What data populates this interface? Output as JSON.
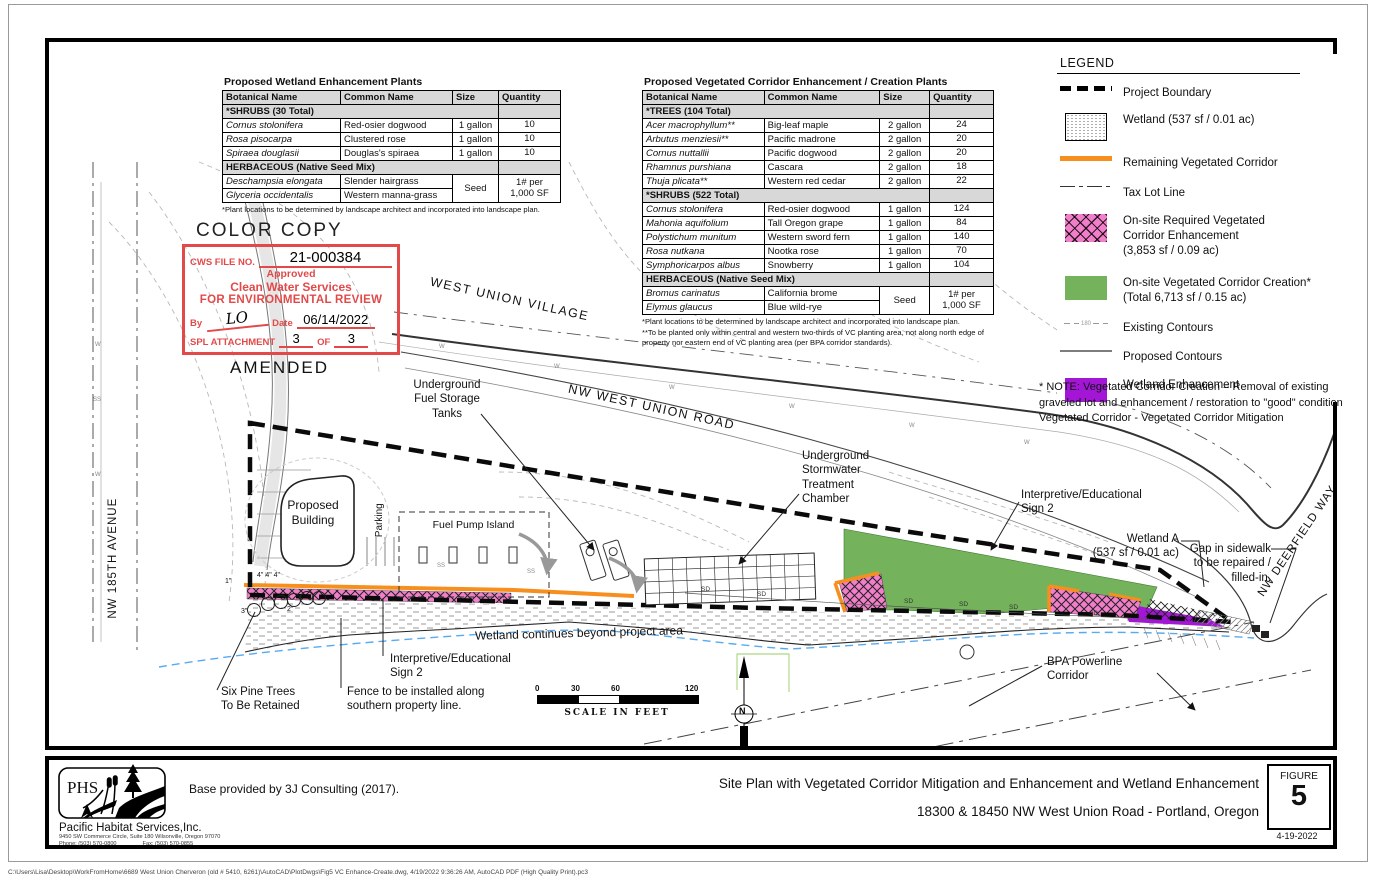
{
  "colors": {
    "green": "#74b35c",
    "pink": "#f07ec9",
    "purple": "#a316d6",
    "orange": "#f78f1e",
    "stamp_red": "#e24a4a",
    "water_blue": "#58aaf0"
  },
  "tables": [
    {
      "title": "Proposed Wetland Enhancement Plants",
      "headers": [
        "Botanical Name",
        "Common Name",
        "Size",
        "Quantity"
      ],
      "rows": [
        {
          "type": "section",
          "label": "*SHRUBS (30 Total)"
        },
        {
          "type": "plant",
          "botanical": "Cornus stolonifera",
          "common": "Red-osier dogwood",
          "size": "1 gallon",
          "qty": "10"
        },
        {
          "type": "plant",
          "botanical": "Rosa pisocarpa",
          "common": "Clustered rose",
          "size": "1 gallon",
          "qty": "10"
        },
        {
          "type": "plant",
          "botanical": "Spiraea douglasii",
          "common": "Douglas's spiraea",
          "size": "1 gallon",
          "qty": "10"
        },
        {
          "type": "section",
          "label": "HERBACEOUS (Native Seed Mix)"
        },
        {
          "type": "seedgroup",
          "plants": [
            [
              "Deschampsia elongata",
              "Slender hairgrass"
            ],
            [
              "Glyceria occidentalis",
              "Western manna-grass"
            ]
          ],
          "size": "Seed",
          "qty": "1# per\n1,000 SF"
        }
      ],
      "footnotes": [
        "*Plant locations to be determined by landscape architect and incorporated into landscape plan."
      ]
    },
    {
      "title": "Proposed Vegetated Corridor Enhancement / Creation Plants",
      "headers": [
        "Botanical Name",
        "Common Name",
        "Size",
        "Quantity"
      ],
      "rows": [
        {
          "type": "section",
          "label": "*TREES (104 Total)"
        },
        {
          "type": "plant",
          "botanical": "Acer macrophyllum**",
          "common": "Big-leaf maple",
          "size": "2 gallon",
          "qty": "24"
        },
        {
          "type": "plant",
          "botanical": "Arbutus menziesii**",
          "common": "Pacific madrone",
          "size": "2 gallon",
          "qty": "20"
        },
        {
          "type": "plant",
          "botanical": "Cornus nuttallii",
          "common": "Pacific dogwood",
          "size": "2 gallon",
          "qty": "20"
        },
        {
          "type": "plant",
          "botanical": "Rhamnus purshiana",
          "common": "Cascara",
          "size": "2 gallon",
          "qty": "18"
        },
        {
          "type": "plant",
          "botanical": "Thuja plicata**",
          "common": "Western red cedar",
          "size": "2 gallon",
          "qty": "22"
        },
        {
          "type": "section",
          "label": "*SHRUBS (522 Total)"
        },
        {
          "type": "plant",
          "botanical": "Cornus stolonifera",
          "common": "Red-osier dogwood",
          "size": "1 gallon",
          "qty": "124"
        },
        {
          "type": "plant",
          "botanical": "Mahonia aquifolium",
          "common": "Tall Oregon grape",
          "size": "1 gallon",
          "qty": "84"
        },
        {
          "type": "plant",
          "botanical": "Polystichum munitum",
          "common": "Western sword fern",
          "size": "1 gallon",
          "qty": "140"
        },
        {
          "type": "plant",
          "botanical": "Rosa nutkana",
          "common": "Nootka rose",
          "size": "1 gallon",
          "qty": "70"
        },
        {
          "type": "plant",
          "botanical": "Symphoricarpos albus",
          "common": "Snowberry",
          "size": "1 gallon",
          "qty": "104"
        },
        {
          "type": "section",
          "label": "HERBACEOUS (Native Seed Mix)"
        },
        {
          "type": "seedgroup",
          "plants": [
            [
              "Bromus carinatus",
              "California brome"
            ],
            [
              "Elymus glaucus",
              "Blue wild-rye"
            ]
          ],
          "size": "Seed",
          "qty": "1# per\n1,000 SF"
        }
      ],
      "footnotes": [
        "*Plant locations to be determined by landscape architect and incorporated into landscape plan.",
        "**To be planted only within central and western two-thirds of VC planting area, not along north edge of property nor eastern end of VC planting area (per BPA corridor standards)."
      ]
    }
  ],
  "legend": {
    "title": "LEGEND",
    "items": [
      {
        "swatch": "project-boundary",
        "text": "Project Boundary"
      },
      {
        "swatch": "wetland",
        "text": "Wetland (537 sf / 0.01 ac)"
      },
      {
        "swatch": "remaining-vc",
        "text": "Remaining Vegetated Corridor"
      },
      {
        "swatch": "tax-lot",
        "text": "Tax Lot Line"
      },
      {
        "swatch": "vc-enhancement",
        "text": "On-site Required Vegetated\nCorridor Enhancement\n(3,853 sf / 0.09 ac)"
      },
      {
        "swatch": "vc-creation",
        "text": "On-site Vegetated Corridor Creation*\n(Total 6,713 sf / 0.15 ac)"
      },
      {
        "swatch": "existing-contours",
        "text": "Existing Contours",
        "swatch_label": "180"
      },
      {
        "swatch": "proposed-contours",
        "text": "Proposed Contours"
      },
      {
        "swatch": "wetland-enhancement",
        "text": "Wetland Enhancement"
      }
    ]
  },
  "vc_note": "* NOTE: Vegetated Corridor Creation = Removal of existing graveled lot and enhancement / restoration to \"good\" condition Vegetated Corridor - Vegetated Corridor Mitigation",
  "stamp": {
    "color_copy": "COLOR COPY",
    "file_label": "CWS FILE NO.",
    "file_no": "21-000384",
    "line1": "Approved",
    "line2": "Clean Water Services",
    "line3": "FOR ENVIRONMENTAL REVIEW",
    "by_label": "By",
    "signature": "LO",
    "date_label": "Date",
    "date_value": "06/14/2022",
    "attach_label": "SPL ATTACHMENT",
    "attach_no": "3",
    "of_label": "OF",
    "attach_total": "3",
    "amended": "AMENDED"
  },
  "plan": {
    "labels": {
      "ust": "Underground\nFuel Storage\nTanks",
      "nw_west_union_road": "NW WEST UNION ROAD",
      "west_union_village": "WEST UNION VILLAGE",
      "stormwater": "Underground\nStormwater\nTreatment\nChamber",
      "sign2_right": "Interpretive/Educational\nSign 2",
      "wetland_a": "Wetland A\n(537 sf / 0.01 ac)",
      "gap": "Gap in sidewalk\nto be repaired /\nfilled-in.",
      "nw_deerfield": "NW DEERFIELD WAY",
      "nw_185th": "NW 185TH AVENUE",
      "parking": "Parking",
      "proposed_building": "Proposed\nBuilding",
      "fuel_pump_island": "Fuel Pump Island",
      "wetland_continues": "Wetland continues beyond project area",
      "six_pine": "Six Pine Trees\nTo Be Retained",
      "sign2_left": "Interpretive/Educational\nSign 2",
      "fence": "Fence to be installed along\nsouthern property line.",
      "bpa": "BPA Powerline\nCorridor"
    },
    "markers": [
      {
        "text": "SD",
        "x": 652,
        "y": 544,
        "cls": ""
      },
      {
        "text": "SD",
        "x": 708,
        "y": 549,
        "cls": ""
      },
      {
        "text": "SD",
        "x": 855,
        "y": 556,
        "cls": ""
      },
      {
        "text": "SD",
        "x": 910,
        "y": 559,
        "cls": ""
      },
      {
        "text": "SD",
        "x": 960,
        "y": 562,
        "cls": ""
      },
      {
        "text": "SD",
        "x": 1040,
        "y": 568,
        "cls": ""
      },
      {
        "text": "W",
        "x": 390,
        "y": 302,
        "cls": "mw"
      },
      {
        "text": "W",
        "x": 505,
        "y": 322,
        "cls": "mw"
      },
      {
        "text": "W",
        "x": 620,
        "y": 343,
        "cls": "mw"
      },
      {
        "text": "W",
        "x": 740,
        "y": 362,
        "cls": "mw"
      },
      {
        "text": "W",
        "x": 860,
        "y": 381,
        "cls": "mw"
      },
      {
        "text": "W",
        "x": 975,
        "y": 398,
        "cls": "mw"
      },
      {
        "text": "W",
        "x": 46,
        "y": 300,
        "cls": "mw"
      },
      {
        "text": "W",
        "x": 46,
        "y": 430,
        "cls": "mw"
      },
      {
        "text": "SS",
        "x": 388,
        "y": 521,
        "cls": "mw"
      },
      {
        "text": "SS",
        "x": 478,
        "y": 527,
        "cls": "mw"
      },
      {
        "text": "SS",
        "x": 44,
        "y": 355,
        "cls": "mw"
      },
      {
        "text": "1\"",
        "x": 176,
        "y": 536,
        "cls": "mdim"
      },
      {
        "text": "4\" 4\" 4\"",
        "x": 208,
        "y": 530,
        "cls": "mdim"
      },
      {
        "text": "2\"",
        "x": 238,
        "y": 564,
        "cls": "mdim"
      },
      {
        "text": "3\"",
        "x": 192,
        "y": 566,
        "cls": "mdim"
      },
      {
        "text": "N",
        "x": 690,
        "y": 664,
        "cls": "mn"
      }
    ]
  },
  "scalebar": {
    "ticks": [
      "0",
      "30",
      "60",
      "120"
    ],
    "caption": "SCALE IN FEET"
  },
  "title_block": {
    "base_note": "Base provided by 3J Consulting (2017).",
    "title_line1": "Site Plan with Vegetated Corridor Mitigation and Enhancement and Wetland Enhancement",
    "title_line2": "18300 & 18450 NW West Union Road - Portland, Oregon",
    "figure_label": "FIGURE",
    "figure_number": "5",
    "date": "4-19-2022",
    "company": {
      "abbr": "PHS",
      "name": "Pacific Habitat Services,Inc.",
      "address": "9450 SW Commerce Circle, Suite 180 Wilsonville, Oregon 97070",
      "phone": "Phone: (503) 570-0800",
      "fax": "Fax: (503) 570-0855"
    }
  },
  "page": {
    "footer_path": "C:\\Users\\Lisa\\Desktop\\WorkFromHome\\6689 West Union Cherveron (old # 5410, 6261)\\AutoCAD\\PlotDwgs\\Fig5 VC Enhance-Create.dwg, 4/19/2022 9:36:26 AM, AutoCAD PDF (High Quality Print).pc3"
  }
}
